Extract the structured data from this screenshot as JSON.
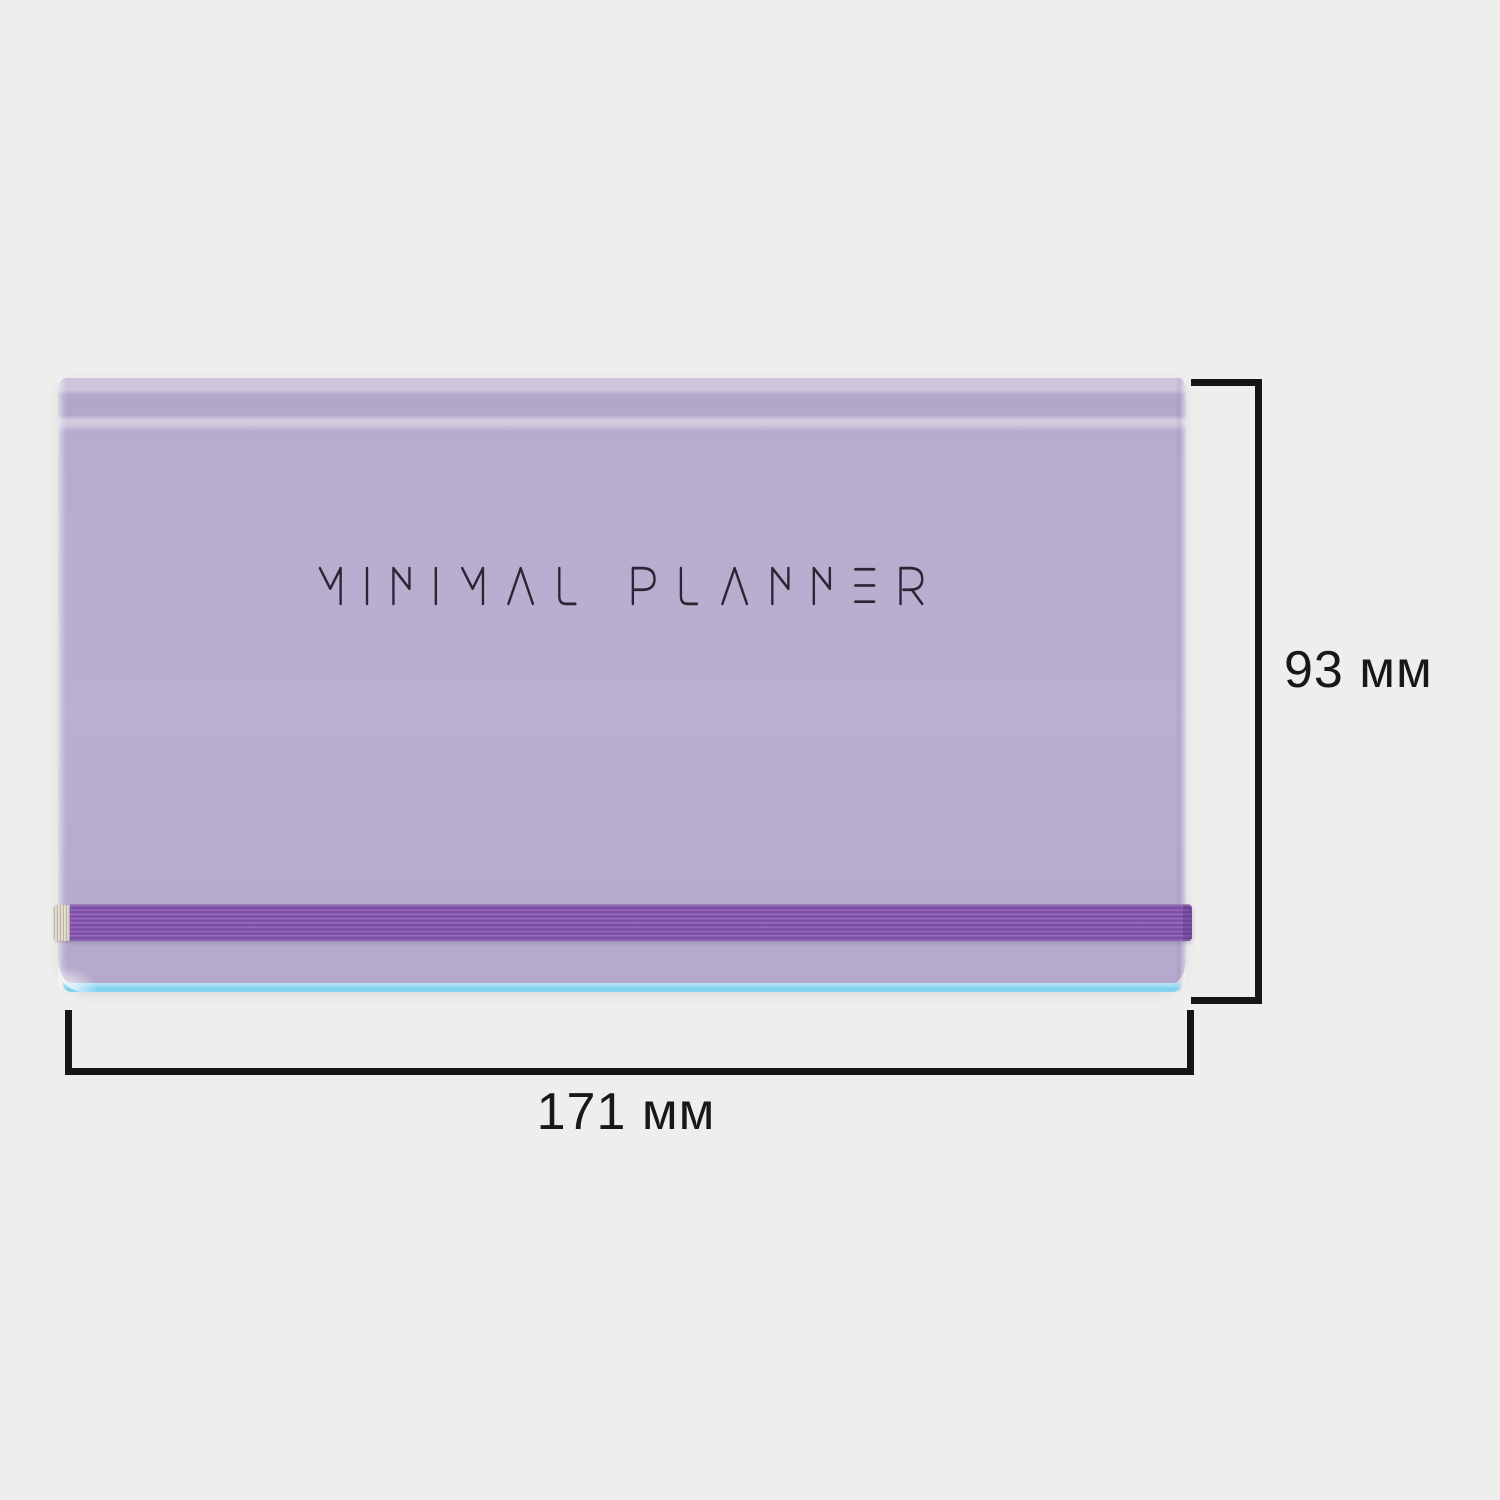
{
  "page": {
    "background": "#efeeec"
  },
  "product": {
    "cover_title": "MINIMAL PLANNER",
    "colors": {
      "cover": "#b7adce",
      "top_strip": "#ccc5db",
      "top_band": "#b2a7ca",
      "divider_line": "#d2cbe0",
      "elastic_band": "#8a5cb4",
      "elastic_band_dark": "#73479d",
      "elastic_band_light": "#9b6fc3",
      "clasp": "#ded7c9",
      "page_edge_blue": "#7fd0f0",
      "title_ink": "#2b2433"
    }
  },
  "dimensions": {
    "height_label": "93 мм",
    "width_label": "171 мм",
    "line_color": "#161616"
  }
}
